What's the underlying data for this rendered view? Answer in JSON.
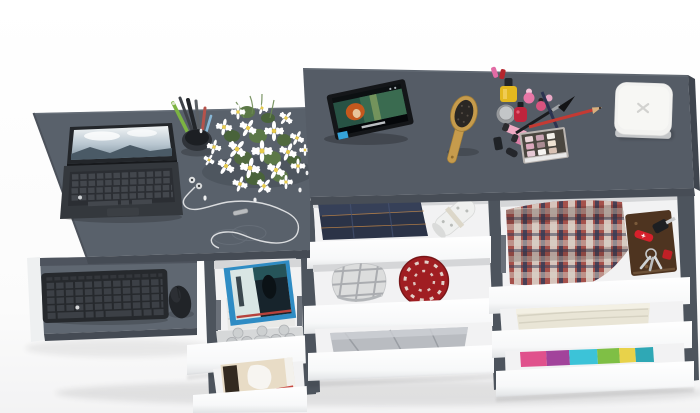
{
  "meta": {
    "description": "Photorealistic 3D render, top view of a dark grey desk and vanity unit with a pull-out keyboard tray and staggered open white drawers filled with clothes and accessories",
    "background": "#fdfdfd"
  },
  "palette": {
    "desk_top": "#59616b",
    "desk_front": "#454b54",
    "vanity_top": "#555c66",
    "vanity_front": "#474d56",
    "vanity_side": "#3f454e",
    "side_panel": "#4d545d",
    "white_panel": "#eef0f1",
    "tray": "#5f6771",
    "tray_front": "#454b54",
    "drawer_interior": "#f2f2f3",
    "interior_shadow": "#d5d6d8",
    "rail": "#6b717a",
    "keyboard_black": "#26292d",
    "mouse_black": "#212428",
    "laptop_body": "#34383d",
    "laptop_keys": "#2b2e33",
    "flower_petal": "#ffffff",
    "flower_center": "#e7cb4e",
    "leaf_green": "#5c7847",
    "denim_blue": "#2b3347",
    "wrap_roll": "#eff0ef",
    "cap_plaid": "#dcdddd",
    "hat_red": "#a01e22",
    "cloth_gray": "#b9bcc1",
    "shirt_plaid_red": "#a5514b",
    "shirt_plaid_navy": "#333c58",
    "notebook_brown": "#4e3420",
    "knife_red": "#d6202b",
    "towel_cream": "#e9e5d6",
    "tee_pink": "#e0518c",
    "tee_purple": "#a2439b",
    "tee_cyan": "#3cc3d8",
    "tee_green": "#7fbf45",
    "tee_yellow": "#e8d24a",
    "tee_teal": "#2fa8b5",
    "magazine_blue": "#2f8cc4",
    "photo_beige": "#e8dcc6",
    "brush_wood": "#c69b4c",
    "box_white": "#f2f2f0",
    "tablet_black": "#141619",
    "polish_yellow": "#e3b81f",
    "gloss_pink": "#f0a9c3",
    "pencil_red": "#c43a33",
    "pencil_navy": "#2c3350",
    "palette_case": "#4a463f"
  },
  "inventory": [
    {
      "area": "desk-top",
      "items": [
        "laptop",
        "pen-cup",
        "flower-bouquet",
        "earphones"
      ]
    },
    {
      "area": "keyboard-tray",
      "items": [
        "wireless-keyboard",
        "mouse"
      ]
    },
    {
      "area": "vanity-top",
      "items": [
        "tablet",
        "hairbrush",
        "cosmetics-set",
        "eyeshadow-palette",
        "white-box"
      ]
    },
    {
      "area": "left-drawers",
      "items": [
        "magazines",
        "desk-organizer",
        "photos"
      ]
    },
    {
      "area": "middle-drawers",
      "items": [
        "folded-jeans",
        "wrapping-roll",
        "plaid-cap",
        "red-knit-hat",
        "grey-clothes"
      ]
    },
    {
      "area": "right-drawers",
      "items": [
        "plaid-shirt",
        "leather-notebook",
        "pocket-knife",
        "keys",
        "car-key",
        "cream-towel",
        "colorful-t-shirts"
      ]
    }
  ]
}
